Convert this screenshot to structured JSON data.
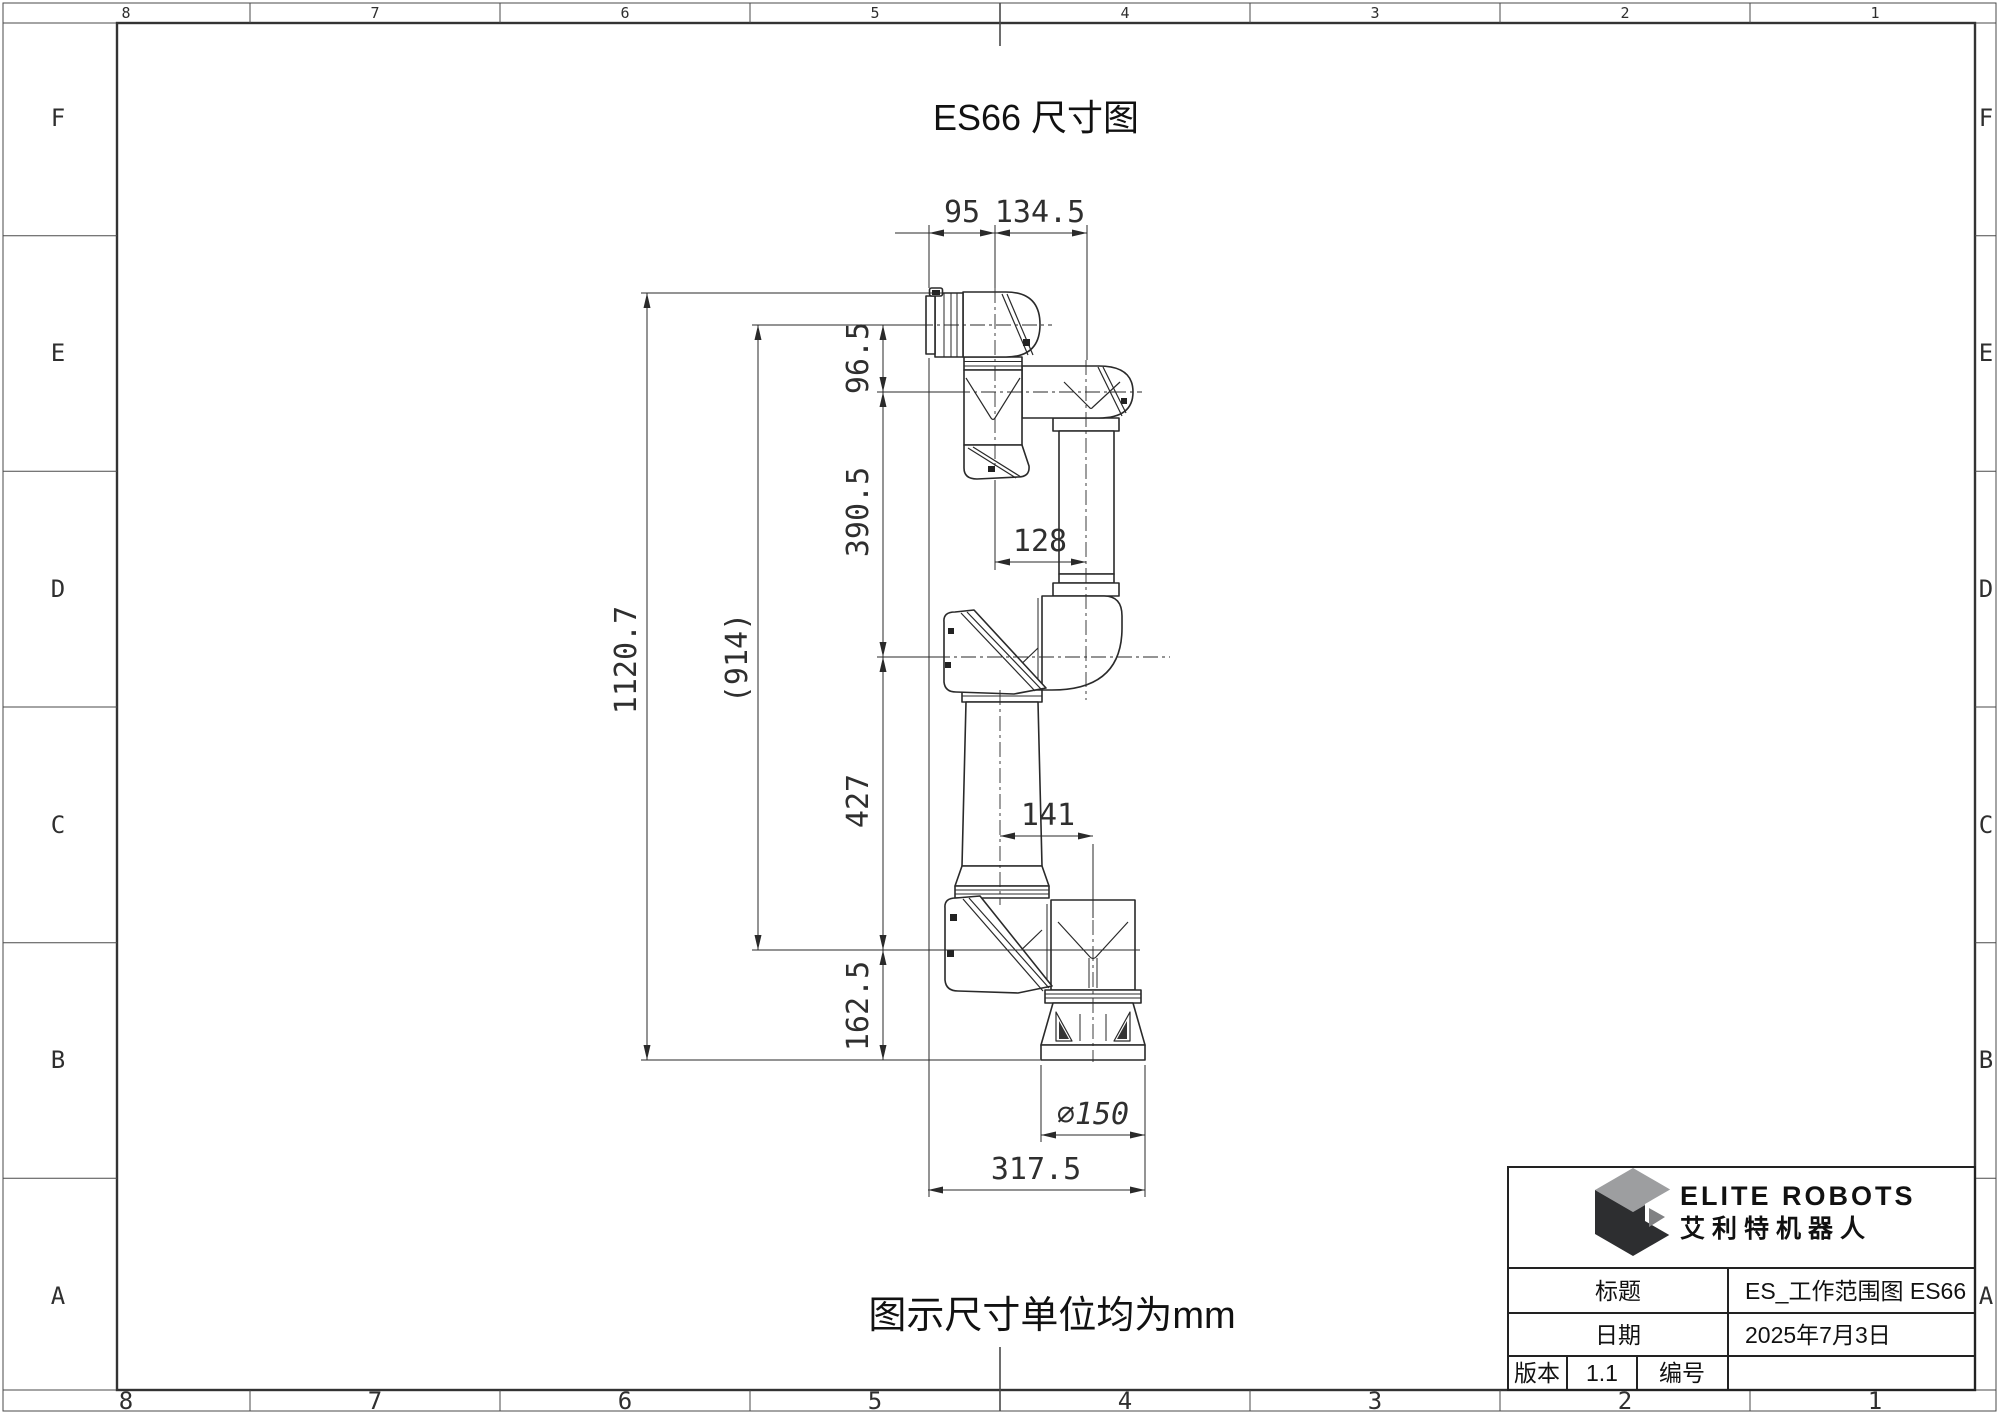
{
  "sheet": {
    "title": "ES66 尺寸图",
    "note": "图示尺寸单位均为mm",
    "grid_columns": [
      "8",
      "7",
      "6",
      "5",
      "4",
      "3",
      "2",
      "1"
    ],
    "grid_rows": [
      "F",
      "E",
      "D",
      "C",
      "B",
      "A"
    ]
  },
  "dimensions": {
    "flange_width": "95",
    "wrist_width": "134.5",
    "wrist_offset": "96.5",
    "forearm_length": "390.5",
    "elbow_offset": "128",
    "total_height": "1120.7",
    "height_ref": "(914)",
    "upper_arm_length": "427",
    "base_offset": "141",
    "base_height": "162.5",
    "base_diameter": "∅150",
    "overall_width": "317.5"
  },
  "title_block": {
    "brand_en": "ELITE ROBOTS",
    "brand_cn": "艾利特机器人",
    "title_label": "标题",
    "title_value": "ES_工作范围图 ES66",
    "date_label": "日期",
    "date_value": "2025年7月3日",
    "version_label": "版本",
    "version_value": "1.1",
    "number_label": "编号",
    "number_value": ""
  }
}
